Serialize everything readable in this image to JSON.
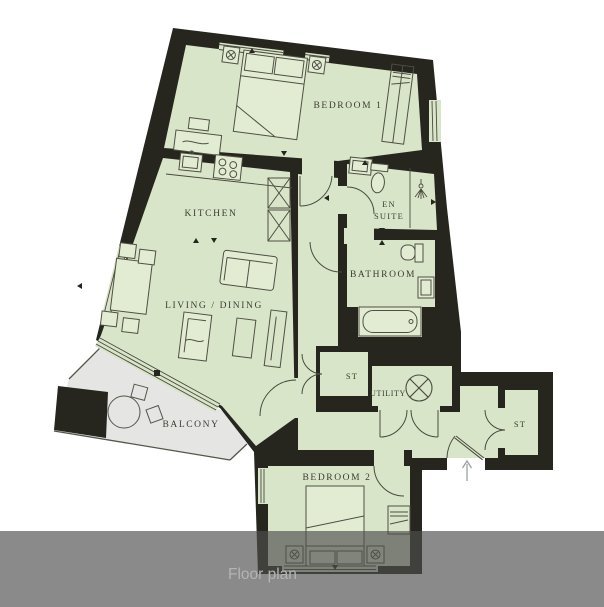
{
  "caption_bar": {
    "label": "Floor plan"
  },
  "rooms": {
    "bedroom1": {
      "label": "BEDROOM 1"
    },
    "kitchen": {
      "label": "KITCHEN"
    },
    "living_dining": {
      "label": "LIVING / DINING"
    },
    "en_suite": {
      "label_line1": "EN",
      "label_line2": "SUITE"
    },
    "bathroom": {
      "label": "BATHROOM"
    },
    "storage1": {
      "label": "ST"
    },
    "utility": {
      "label": "UTILITY"
    },
    "storage2": {
      "label": "ST"
    },
    "bedroom2": {
      "label": "BEDROOM 2"
    },
    "balcony": {
      "label": "BALCONY"
    }
  },
  "icons": {
    "utility_appliance": "washing-machine-icon",
    "en_suite_fitting": "shower-head-icon",
    "entrance": "entrance-arrow-up-icon"
  },
  "colors": {
    "wall": "#26261f",
    "floor": "#d9e5c8",
    "balcony_floor": "#e5e5e3",
    "furniture_fill": "#e2ecd3",
    "line": "#4a4a40",
    "label_text": "#3c3c32",
    "caption_text": "#b5b3b5",
    "caption_bar": "rgba(78,78,78,0.66)",
    "entrance_arrow": "#9aa0a2"
  }
}
